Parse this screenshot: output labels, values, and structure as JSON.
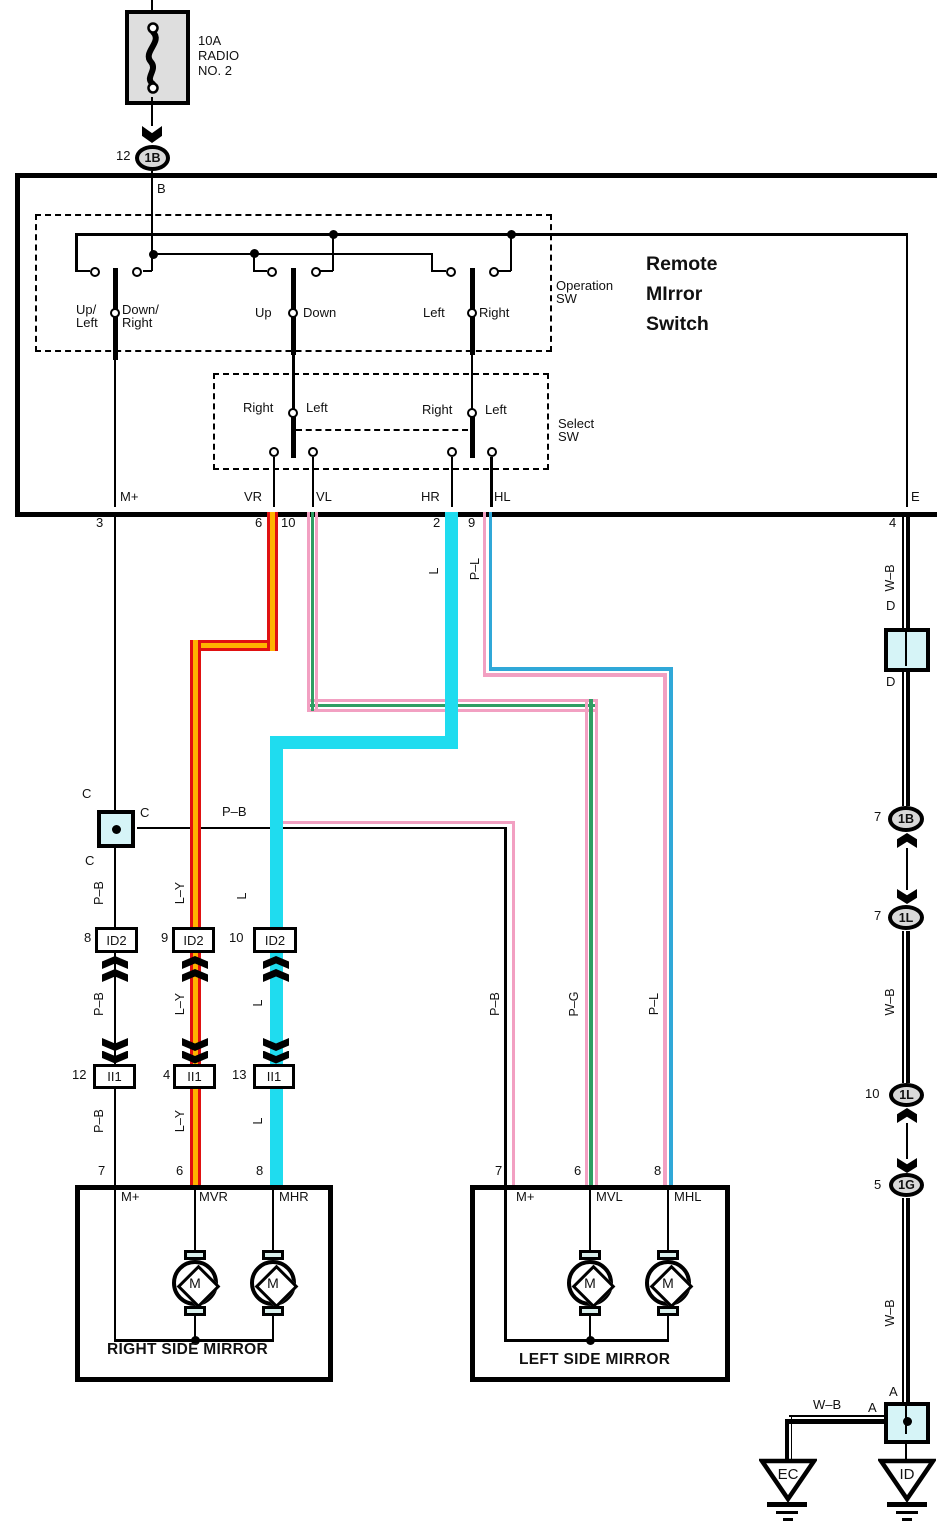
{
  "fuse": {
    "amp": "10A",
    "name1": "RADIO",
    "name2": "NO. 2",
    "pin": "12",
    "code": "1B",
    "wire_out": "B"
  },
  "title": {
    "l1": "Remote",
    "l2": "MIrror",
    "l3": "Switch"
  },
  "operation_sw": {
    "lab1": "Operation",
    "lab2": "SW",
    "sw1l1": "Up/",
    "sw1l2": "Left",
    "sw1r1": "Down/",
    "sw1r2": "Right",
    "sw2l": "Up",
    "sw2r": "Down",
    "sw3l": "Left",
    "sw3r": "Right"
  },
  "select_sw": {
    "lab1": "Select",
    "lab2": "SW",
    "s1l": "Right",
    "s1r": "Left",
    "s2l": "Right",
    "s2r": "Left"
  },
  "pins": {
    "m": "M+",
    "m_n": "3",
    "vr": "VR",
    "vr_n": "6",
    "vl": "VL",
    "vl_n": "10",
    "hr": "HR",
    "hr_n": "2",
    "hl": "HL",
    "hl_n": "9",
    "e": "E",
    "e_n": "4"
  },
  "wire_labels": {
    "l_top": "L",
    "pl_top": "P–L",
    "pb_branch": "P–B",
    "col_pb": [
      "P–B",
      "P–B",
      "P–B"
    ],
    "col_ly": [
      "L–Y",
      "L–Y",
      "L–Y"
    ],
    "col_l": [
      "L",
      "L",
      "L"
    ],
    "lm_pb": "P–B",
    "lm_pg": "P–G",
    "lm_pl": "P–L",
    "wb": [
      "W–B",
      "W–B",
      "W–B",
      "W–B"
    ]
  },
  "connectors": {
    "c": [
      "C",
      "C",
      "C"
    ],
    "d": [
      "D",
      "D"
    ],
    "a": [
      "A",
      "A"
    ],
    "id2": {
      "code": "ID2",
      "pins": [
        "8",
        "9",
        "10"
      ]
    },
    "ii1": {
      "code": "II1",
      "pins": [
        "12",
        "4",
        "13"
      ]
    },
    "ovals": [
      {
        "pin": "7",
        "code": "1B"
      },
      {
        "pin": "7",
        "code": "1L"
      },
      {
        "pin": "10",
        "code": "1L"
      },
      {
        "pin": "5",
        "code": "1G"
      }
    ]
  },
  "right_mirror": {
    "title": "RIGHT SIDE MIRROR",
    "p1": "M+",
    "p2": "MVR",
    "p3": "MHR",
    "n1": "7",
    "n2": "6",
    "n3": "8",
    "motor": "M"
  },
  "left_mirror": {
    "title": "LEFT SIDE MIRROR",
    "p1": "M+",
    "p2": "MVL",
    "p3": "MHL",
    "n1": "7",
    "n2": "6",
    "n3": "8",
    "motor": "M"
  },
  "grounds": {
    "ec": "EC",
    "id": "ID"
  },
  "colors": {
    "cyan": "#1fdcef",
    "red": "#e01111",
    "yellow": "#ffb400",
    "pink": "#f2a0c2",
    "green": "#2f9e63",
    "blue": "#30a8d8",
    "connector_fill": "#d6f4f7"
  }
}
